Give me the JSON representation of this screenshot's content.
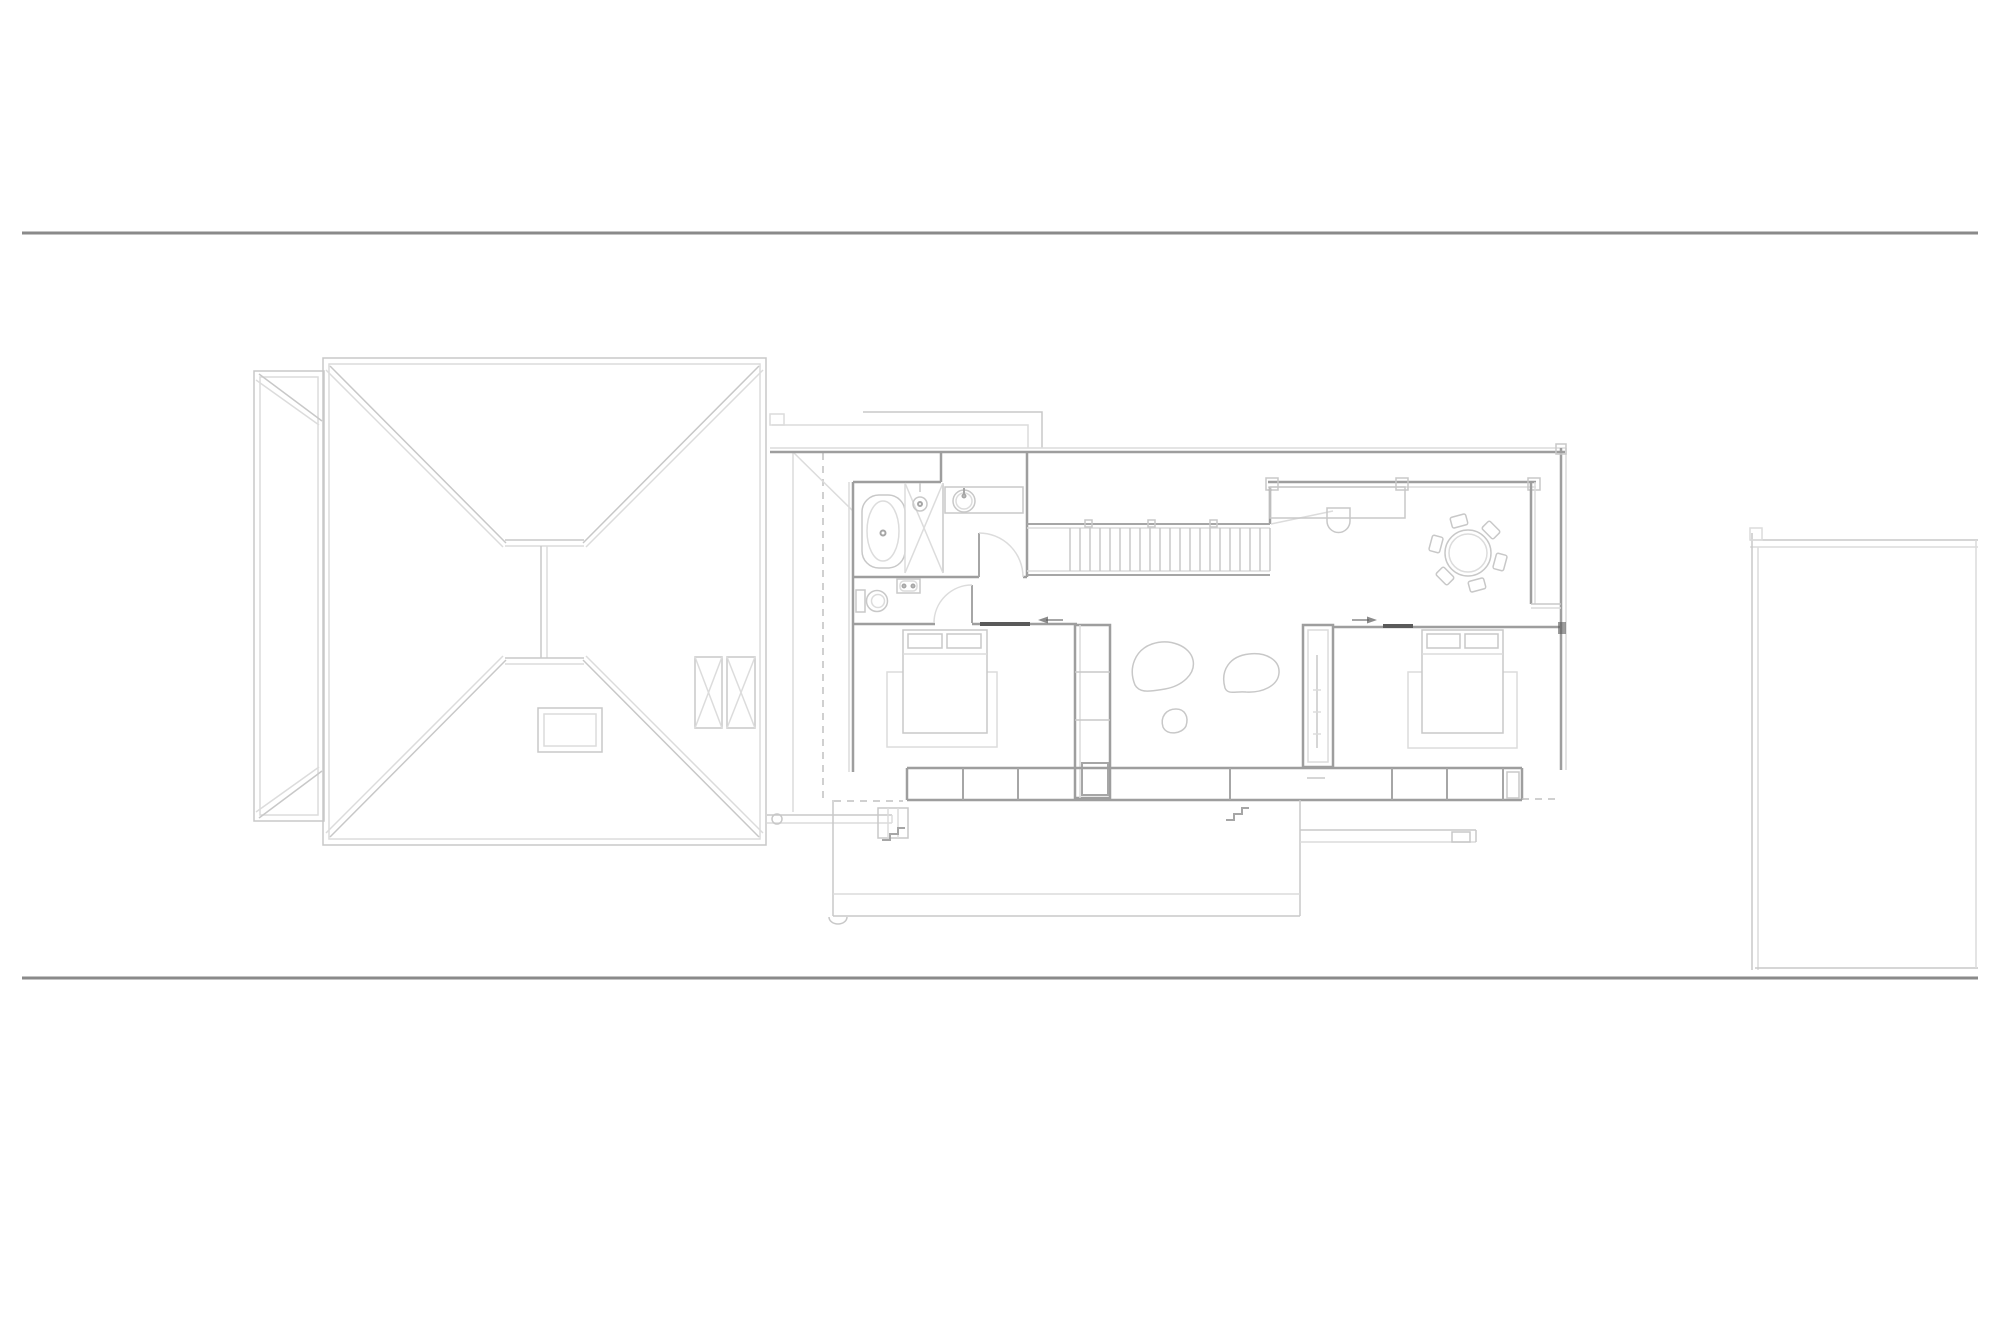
{
  "document": {
    "kind": "architectural-floor-plan",
    "level_shown": "upper floor with roof plan",
    "visible_text": []
  },
  "colors": {
    "bg": "#ffffff",
    "boundary": "#8a8a8a",
    "line_xlight": "#dcdcdc",
    "line_light": "#c8c8c8",
    "line_medium": "#a6a6a6",
    "wall": "#9e9e9e",
    "dark": "#5a5a5a",
    "dashed": "#c0c0c0"
  },
  "components": {
    "site": [
      "top-boundary-line",
      "bottom-boundary-line"
    ],
    "roof_plan": [
      "left-wing-roof",
      "main-hip-roof",
      "ridge-lines",
      "chimney",
      "skylight-hatches"
    ],
    "floor_plan": [
      "bathroom",
      "bathtub",
      "shower",
      "vanity-sink",
      "toilet",
      "wash-basin",
      "swing-doors",
      "staircase",
      "balustrade",
      "desk",
      "desk-chair",
      "dining-table",
      "dining-chairs",
      "bedroom-1-bed",
      "bedroom-1-rug",
      "bedroom-2-bed",
      "bedroom-2-rug",
      "wardrobes",
      "stone-ottomans",
      "window-seat-band",
      "deck",
      "entry-arrows",
      "door-thresholds"
    ],
    "context": [
      "neighbour-building-outline"
    ]
  }
}
